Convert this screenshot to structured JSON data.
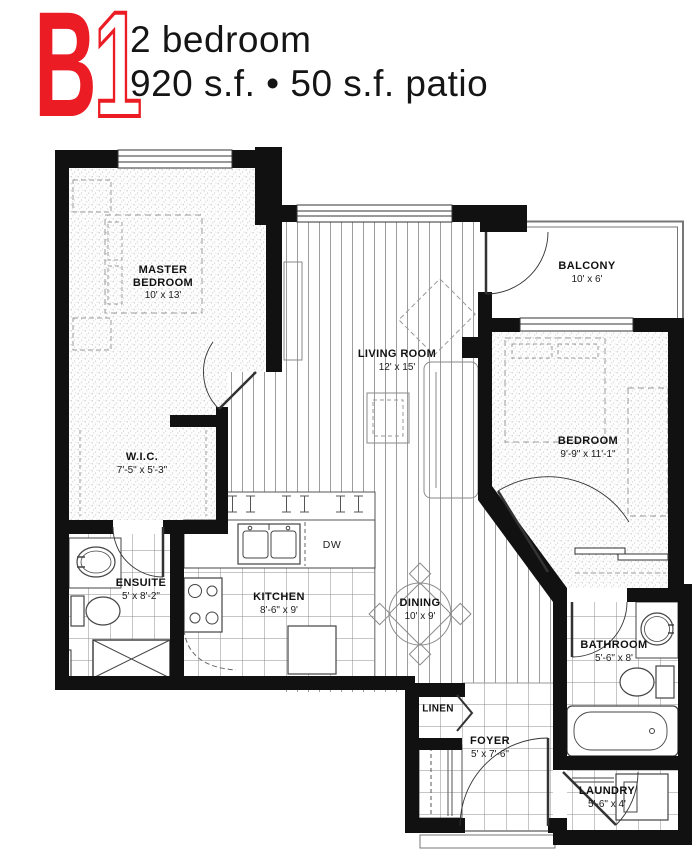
{
  "header": {
    "unit_letter": "B",
    "unit_number": "1",
    "subtitle_line1": "2 bedroom",
    "subtitle_line2": "920 s.f. • 50 s.f. patio"
  },
  "colors": {
    "accent": "#EC1C24",
    "wall": "#111111"
  },
  "rooms": {
    "master_bedroom": {
      "name": "MASTER BEDROOM",
      "dims": "10' x 13'"
    },
    "wic": {
      "name": "W.I.C.",
      "dims": "7'-5\" x 5'-3\""
    },
    "ensuite": {
      "name": "ENSUITE",
      "dims": "5' x 8'-2\""
    },
    "kitchen": {
      "name": "KITCHEN",
      "dims": "8'-6\" x 9'"
    },
    "living_room": {
      "name": "LIVING ROOM",
      "dims": "12' x 15'"
    },
    "dining": {
      "name": "DINING",
      "dims": "10' x 9'"
    },
    "balcony": {
      "name": "BALCONY",
      "dims": "10' x 6'"
    },
    "bedroom": {
      "name": "BEDROOM",
      "dims": "9'-9\" x 11'-1\""
    },
    "bathroom": {
      "name": "BATHROOM",
      "dims": "5'-6\" x 8'"
    },
    "foyer": {
      "name": "FOYER",
      "dims": "5' x 7'-6\""
    },
    "laundry": {
      "name": "LAUNDRY",
      "dims": "5'-6\" x 4'"
    },
    "linen": {
      "name": "LINEN"
    },
    "appliances": {
      "dishwasher": "DW"
    }
  }
}
